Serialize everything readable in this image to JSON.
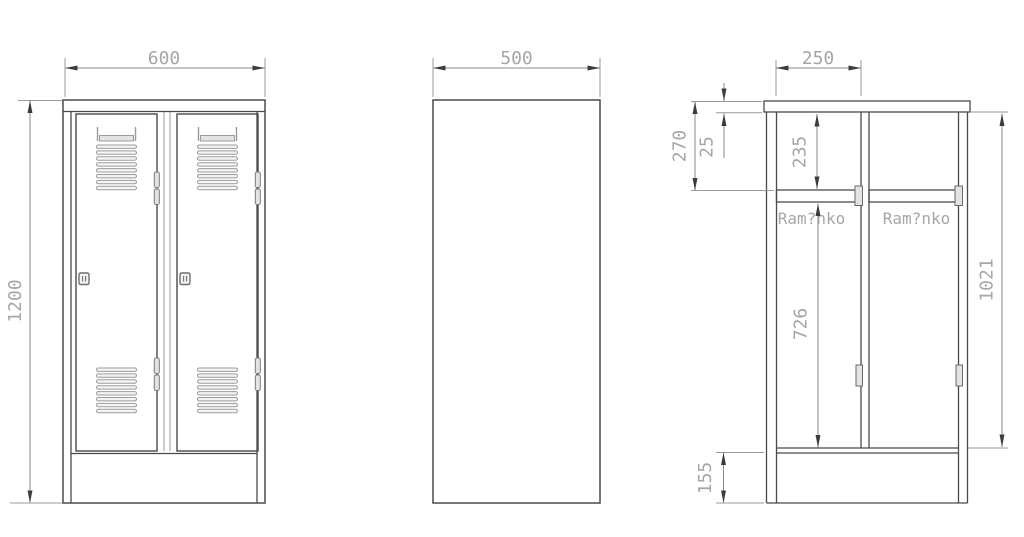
{
  "drawing": {
    "front_view": {
      "width_dim": "600",
      "height_dim": "1200"
    },
    "side_view": {
      "depth_dim": "500"
    },
    "section_view": {
      "compartment_width_dim": "250",
      "top_zone_dim": "270",
      "top_panel_dim": "25",
      "above_shelf_dim": "235",
      "hanging_zone_dim": "726",
      "interior_height_dim": "1021",
      "plinth_dim": "155",
      "left_rail_label": "Ram?nko",
      "right_rail_label": "Ram?nko"
    }
  },
  "colors": {
    "background": "#ffffff",
    "line-strong": "#4a4a4a",
    "line-medium": "#8a8a8a",
    "line-light": "#9b9b9b",
    "arrow": "#3c3c3c",
    "dim-text": "#a6a6a6",
    "fill-light": "#e3e3e3",
    "fill-slat": "#f4f4f4"
  }
}
